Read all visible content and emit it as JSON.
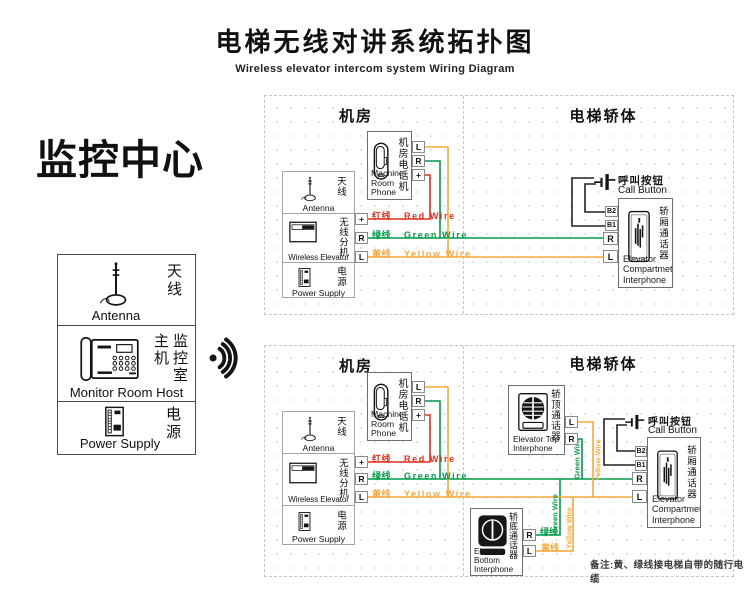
{
  "header": {
    "title_zh": "电梯无线对讲系统拓扑图",
    "title_en": "Wireless elevator intercom system Wiring Diagram"
  },
  "monitor_center": {
    "heading": "监控中心",
    "antenna_zh": "天线",
    "antenna_en": "Antenna",
    "host_zh": "监控室主机",
    "host_en": "Monitor Room Host",
    "power_zh": "电源",
    "power_en": "Power Supply"
  },
  "sections": {
    "machine_room": "机房",
    "elevator_car": "电梯轿体"
  },
  "machine_room_phone": {
    "zh": "机房电话机",
    "en_line1": "Machine",
    "en_line2": "Room Phone"
  },
  "equipment": {
    "antenna_zh": "天线",
    "antenna_en": "Antenna",
    "wireless_zh": "无线分机",
    "wireless_en": "Wireless Elevator",
    "power_zh": "电源",
    "power_en": "Power Supply"
  },
  "call_button": {
    "zh": "呼叫按钮",
    "en": "Call Button"
  },
  "compartment_interphone": {
    "zh": "轿厢通话器",
    "en_line1": "Elevator",
    "en_line2": "Compartmet",
    "en_line3": "Interphone"
  },
  "top_interphone": {
    "zh": "轿顶通话器",
    "en_line1": "Elevator Top",
    "en_line2": "Interphone"
  },
  "bottom_interphone": {
    "zh": "轿底通话器",
    "en_line1": "Elevator Bottom",
    "en_line2": "Interphone"
  },
  "terminals": {
    "l": "L",
    "r": "R",
    "plus": "+",
    "b1": "B1",
    "b2": "B2"
  },
  "wires": {
    "red": {
      "zh": "红线",
      "en": "Red Wire",
      "color": "#e0301e"
    },
    "green": {
      "zh": "绿线",
      "en": "Green Wire",
      "color": "#009b48"
    },
    "yellow": {
      "zh": "黄线",
      "en": "Yellow Wire",
      "color": "#f5a93c"
    }
  },
  "note": "备注:黄、绿线接电梯自带的随行电缆"
}
